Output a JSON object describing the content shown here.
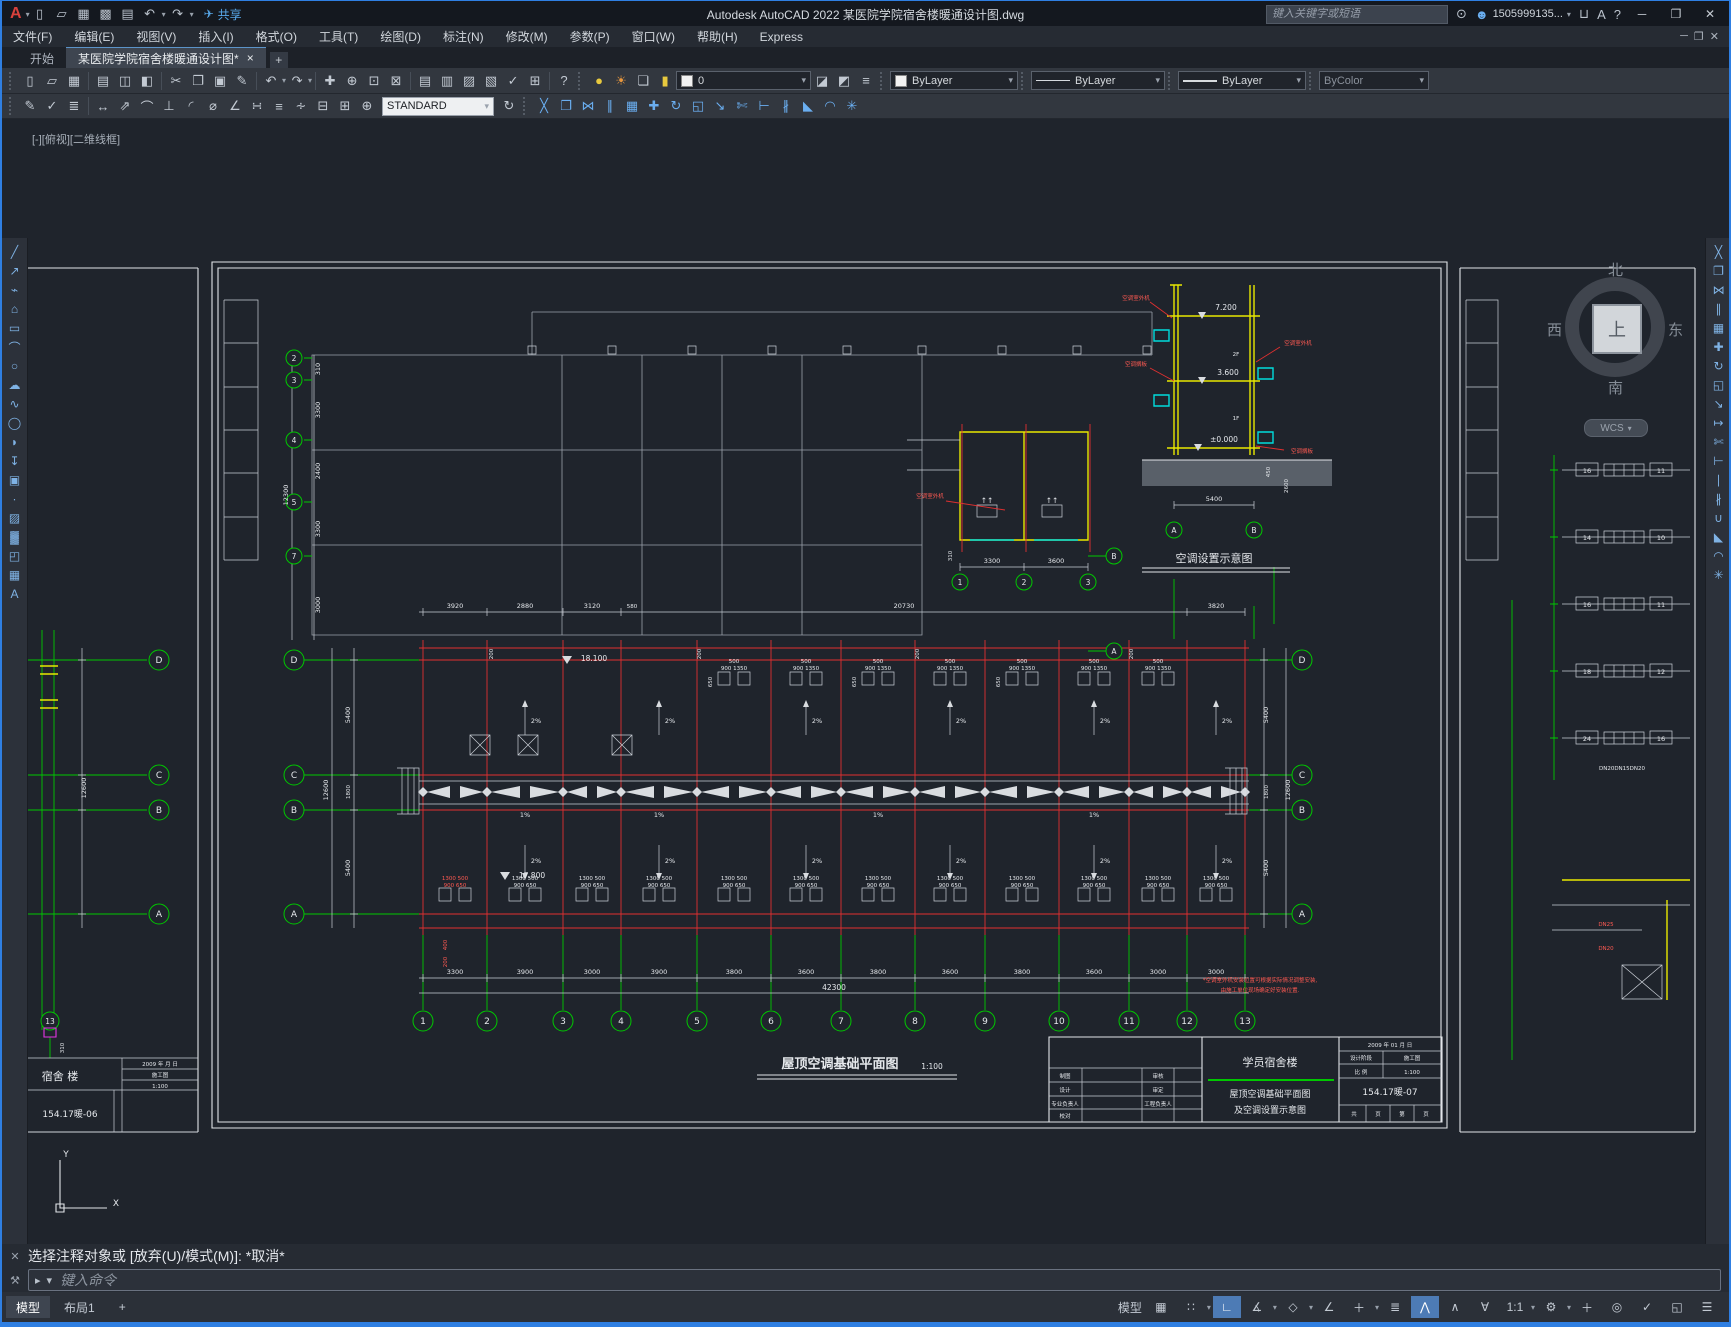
{
  "window_title": "Autodesk AutoCAD 2022   某医院学院宿舍楼暖通设计图.dwg",
  "titlebar": {
    "share": "共享",
    "search_placeholder": "键入关键字或短语",
    "user": "1505999135...",
    "help": "?"
  },
  "menubar": [
    "文件(F)",
    "编辑(E)",
    "视图(V)",
    "插入(I)",
    "格式(O)",
    "工具(T)",
    "绘图(D)",
    "标注(N)",
    "修改(M)",
    "参数(P)",
    "窗口(W)",
    "帮助(H)",
    "Express"
  ],
  "file_tabs": {
    "start": "开始",
    "doc": "某医院学院宿舍楼暖通设计图*",
    "close": "×",
    "add": "+"
  },
  "ribbon": {
    "layer": "0",
    "color": "ByLayer",
    "linetype": "ByLayer",
    "lineweight": "ByLayer",
    "plotstyle": "ByColor",
    "textstyle": "STANDARD"
  },
  "cmd": {
    "history": "选择注释对象或 [放弃(U)/模式(M)]: *取消*",
    "placeholder": "键入命令"
  },
  "layout_tabs": {
    "model": "模型",
    "layout1": "布局1",
    "add": "+"
  },
  "statusbar": {
    "model": "模型",
    "scale": "1:1"
  },
  "ucs": {
    "x": "X",
    "y": "Y"
  },
  "icons": {
    "logo": "A",
    "caret": "▾",
    "qnew": "▯",
    "open": "▱",
    "save": "▦",
    "saveas": "▩",
    "plot": "▤",
    "preview": "◫",
    "publish": "◧",
    "undo": "↶",
    "redo": "↷",
    "share": "✈",
    "search": "⊙",
    "user": "☻",
    "cart": "⊔",
    "autodesk": "A",
    "help": "?",
    "min": "─",
    "max": "❐",
    "close": "✕",
    "cut": "✂",
    "copy": "❐",
    "paste": "▣",
    "match": "✎",
    "pan": "✚",
    "zoom_rt": "⊕",
    "zoom_win": "⊡",
    "zoom_prev": "⊠",
    "props": "▤",
    "dcenter": "▥",
    "palettes": "▨",
    "sheetset": "▧",
    "markup": "✓",
    "calc": "⊞",
    "sync": "↻",
    "bulb": "●",
    "sun": "☀",
    "frame": "❏",
    "lock": "▮",
    "mk_current": "◪",
    "layer_prev": "◩",
    "layer_states": "≡",
    "dim_edit": "✎",
    "dim_check": "✓",
    "dim_styles": "≣",
    "dim_linear": "↔",
    "dim_aligned": "⇗",
    "dim_arc": "⌒",
    "dim_ord": "⊥",
    "dim_rad": "◜",
    "dim_dia": "⌀",
    "dim_ang": "∠",
    "dim_quick": "∺",
    "dim_base": "≡",
    "dim_cont": "∻",
    "dim_break": "⊟",
    "dim_tol": "⊞",
    "dim_center": "⊕",
    "dim_update": "↻",
    "erase": "╳",
    "mirror": "⋈",
    "offset": "∥",
    "array": "▦",
    "move": "✚",
    "rotate": "↻",
    "scale": "◱",
    "stretch": "↘",
    "lengthen": "↦",
    "trim": "✄",
    "extend": "⊢",
    "break_pt": "∣",
    "break": "∦",
    "join": "∪",
    "chamfer": "◣",
    "fillet": "◠",
    "explode": "✳",
    "line": "╱",
    "ray": "↗",
    "pline": "⌁",
    "polygon": "⌂",
    "rect": "▭",
    "arc": "⌒",
    "circle": "○",
    "revcloud": "☁",
    "spline": "∿",
    "ellipse": "◯",
    "earc": "◗",
    "insert": "↧",
    "block": "▣",
    "point": "∙",
    "hatch": "▨",
    "gradient": "▓",
    "region": "◰",
    "table": "▦",
    "mtext": "A",
    "grid": "▦",
    "snap": "∷",
    "ortho": "∟",
    "polar": "∡",
    "iso": "◇",
    "otrack": "∠",
    "dyn": "＋",
    "lwt": "≣",
    "osnap": "⋀",
    "osnap2": "∧",
    "osnap3d": "∀",
    "gear": "⚙",
    "plus": "＋",
    "isolate": "◎",
    "gcheck": "✓",
    "fullscreen": "◱",
    "burger": "☰",
    "wrench": "⚒",
    "cmdicon": "▸",
    "x": "✕"
  },
  "drawing": {
    "viewport_label": "[-][俯视][二维线框]",
    "viewcube": {
      "n": "北",
      "e": "东",
      "s": "南",
      "w": "西",
      "top": "上",
      "wcs": "WCS"
    },
    "main_plan": {
      "title": "屋顶空调基础平面图",
      "scale": "1:100",
      "axis_nums": [
        "1",
        "2",
        "3",
        "4",
        "5",
        "6",
        "7",
        "8",
        "9",
        "10",
        "11",
        "12",
        "13"
      ],
      "rows": [
        "D",
        "C",
        "B",
        "A"
      ],
      "bottom_dims": [
        "3300",
        "3900",
        "3000",
        "3900",
        "3800",
        "3600",
        "3800",
        "3600",
        "3800",
        "3600",
        "3000",
        "3000"
      ],
      "total": "42300",
      "top_dims": [
        "3920",
        "2880",
        "3120",
        "580",
        "20730",
        "3820"
      ],
      "side_dims": [
        "5400",
        "1800",
        "5400"
      ],
      "side_total": "12600",
      "gray_col_nums": [
        "2",
        "3",
        "4",
        "5",
        "7"
      ],
      "gray_col_dims": [
        "310",
        "3300",
        "2400",
        "3300",
        "3000"
      ],
      "gray_col_total": "12300",
      "level_top": "18.100",
      "level_low": "17.800",
      "slope": "2%",
      "slope_mid": "1%",
      "edge_dim": "200",
      "pad_top_l1": "500",
      "pad_top_l2": "900 1350",
      "pad_side": "650",
      "pad_bot_l1": "1300 500",
      "pad_bot_l2": "900 650",
      "red_dim_a": "400",
      "red_dim_b": "200",
      "note1": "*空调室外机安装位置可根据实际情况调整安装,",
      "note2": "由施工单位现场确定好安装位置."
    },
    "unit_plan": {
      "dims": [
        "3300",
        "3600"
      ],
      "dim_small": "310",
      "axis": [
        "1",
        "2",
        "3"
      ],
      "rows": [
        "B",
        "A"
      ],
      "ann": "空调室外机",
      "arrow": "↑↑"
    },
    "section": {
      "title": "空调设置示意图",
      "levels": [
        "7.200",
        "3.600",
        "±0.000"
      ],
      "floors": [
        "2F",
        "1F"
      ],
      "dim_w": "5400",
      "dim_h": "2600",
      "dim_p": "450",
      "rows": [
        "A",
        "B"
      ],
      "ann1": "空调室外机",
      "ann2": "空调搁板"
    },
    "right_sheet": {
      "risers": [
        [
          "16",
          "11"
        ],
        [
          "14",
          "10"
        ],
        [
          "16",
          "11"
        ],
        [
          "18",
          "12"
        ],
        [
          "24",
          "16"
        ]
      ],
      "riser_label": "DN20DN15DN20",
      "pipe1": "DN25",
      "pipe2": "DN20"
    },
    "left_sheet": {
      "rows": [
        "D",
        "C",
        "B",
        "A"
      ],
      "axis": "13",
      "dim": "12600",
      "dim_small": "310",
      "tb_project": "宿舍 楼",
      "tb_name1": "采暖",
      "tb_name2": "平面图",
      "tb_no": "154.17暖-06",
      "tb_stage": "施工图",
      "tb_scale": "1:100",
      "tb_date": "2009 年 月 日"
    },
    "titleblock": {
      "date": "2009 年 01 月 日",
      "stage_label": "设计阶段",
      "stage": "施工图",
      "scale_label": "比 例",
      "scale": "1:100",
      "project": "学员宿舍楼",
      "name1": "屋顶空调基础平面图",
      "name2": "及空调设置示意图",
      "no": "154.17暖-07",
      "pages": [
        "共",
        "页",
        "第",
        "页"
      ],
      "roles": [
        [
          "制图",
          "审核"
        ],
        [
          "设计",
          "审定"
        ],
        [
          "专业负责人",
          "工程负责人"
        ],
        [
          "校对",
          ""
        ]
      ]
    }
  }
}
